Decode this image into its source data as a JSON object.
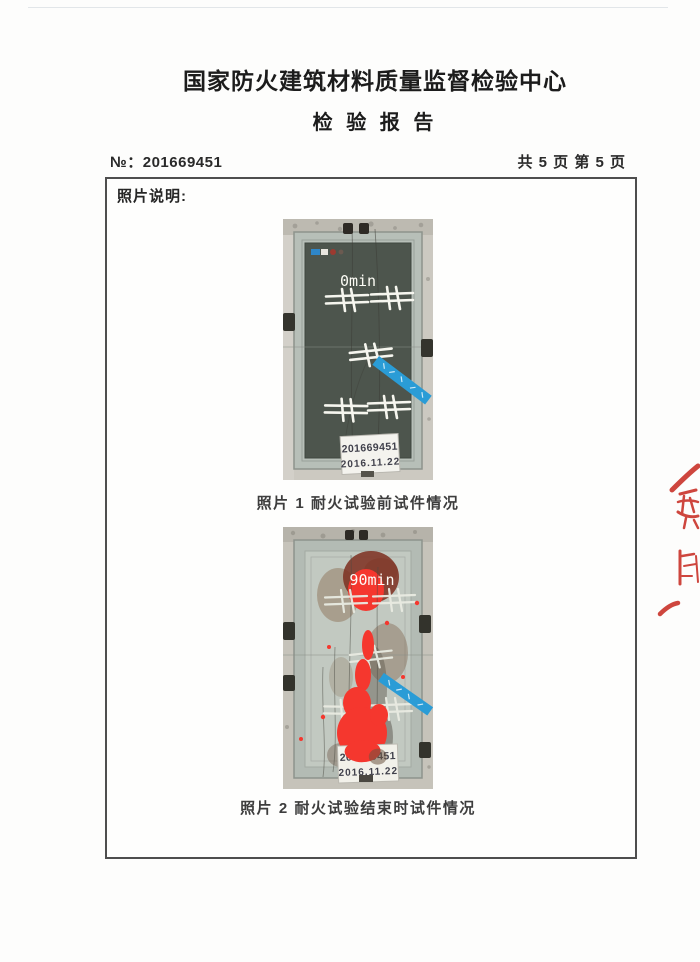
{
  "header": {
    "org_title": "国家防火建筑材料质量监督检验中心",
    "report_title": "检 验 报 告",
    "report_no_label": "№：",
    "report_no": "201669451",
    "page_info": "共 5 页 第 5 页"
  },
  "photo_section": {
    "heading": "照片说明:",
    "photos": [
      {
        "time_label": "0min",
        "specimen_label_line1": "201669451",
        "specimen_label_line2": "2016.11.22",
        "caption": "照片 1 耐火试验前试件情况"
      },
      {
        "time_label": "90min",
        "specimen_label_line1": "201669451",
        "specimen_label_line2": "2016.11.22",
        "caption": "照片 2 耐火试验结束时试件情况"
      }
    ]
  },
  "colors": {
    "stamp_red": "#c6271d",
    "tape_blue": "#2a9cd6",
    "marker_red": "#f5372e",
    "door_dark_green": "#4d554d",
    "door_after_test": "#c2c9c1",
    "burn_brown": "#8a6a4e"
  }
}
